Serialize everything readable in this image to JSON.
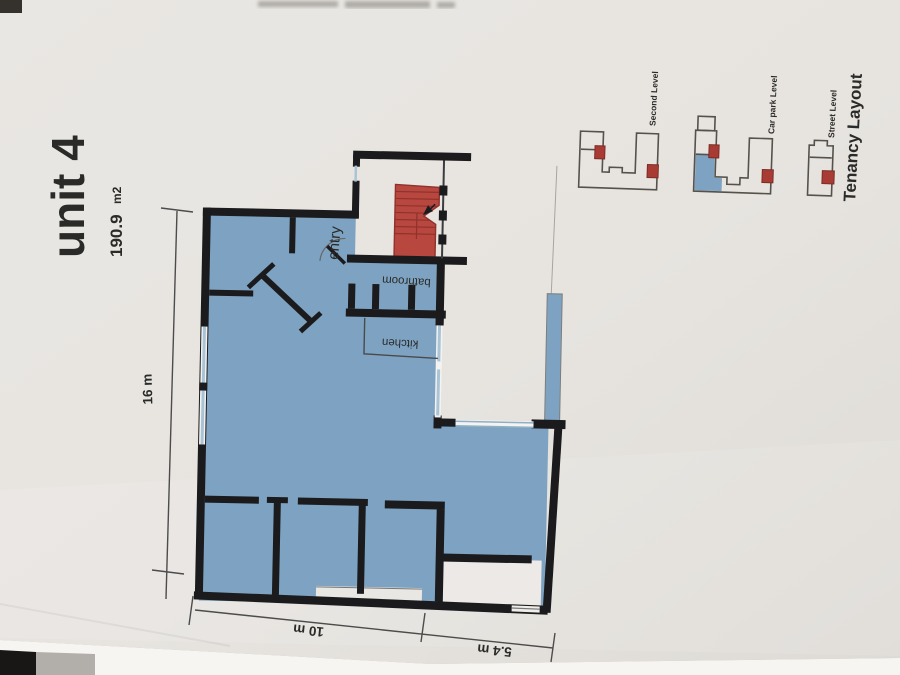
{
  "document": {
    "title": "unit 4",
    "area_value": "190.9",
    "area_unit": "m2"
  },
  "floor_plan": {
    "room_labels": {
      "entry": "entry",
      "bathroom": "bathroom",
      "kitchen": "kitchen"
    },
    "dimensions": {
      "height": "16 m",
      "width_main": "10 m",
      "width_extension": "5.4 m"
    }
  },
  "tenancy_layout": {
    "caption": "Tenancy Layout",
    "levels": [
      {
        "label": "Second Level"
      },
      {
        "label": "Car park Level"
      },
      {
        "label": "Street Level"
      }
    ]
  },
  "colors": {
    "unit_fill": "#7ea3c2",
    "stairs_fill": "#b8473f",
    "level_marker_red": "#a83c35",
    "wall_black": "#1b1b1d",
    "window_blue": "#a9c4d6",
    "caption_gray": "#97969a",
    "paper": "#e8e6e2"
  }
}
